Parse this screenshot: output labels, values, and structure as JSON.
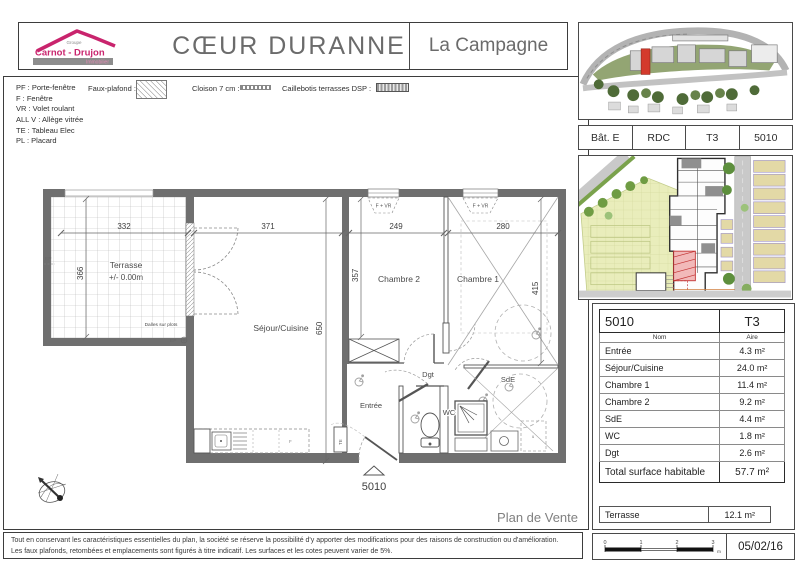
{
  "logo": {
    "group": "Groupe",
    "name": "Carnot - Drujon",
    "tagline": "Immobilier"
  },
  "header": {
    "title": "CŒUR DURANNE",
    "subtitle": "La Campagne"
  },
  "legend": {
    "abbreviations": [
      "PF : Porte-fenêtre",
      "F : Fenêtre",
      "VR : Volet roulant",
      "ALL V : Allège vitrée",
      "TE : Tableau Elec",
      "PL : Placard"
    ],
    "faux_plafond": "Faux-plafond :",
    "cloison": "Cloison 7 cm :",
    "caillebotis": "Caillebotis terrasses DSP :"
  },
  "sidebar": {
    "unit_row": [
      "Bât. E",
      "RDC",
      "T3",
      "5010"
    ],
    "area_table": {
      "unit": "5010",
      "type": "T3",
      "col_name": "Nom",
      "col_area": "Aire",
      "rows": [
        [
          "Entrée",
          "4.3 m²"
        ],
        [
          "Séjour/Cuisine",
          "24.0 m²"
        ],
        [
          "Chambre 1",
          "11.4 m²"
        ],
        [
          "Chambre 2",
          "9.2 m²"
        ],
        [
          "SdE",
          "4.4 m²"
        ],
        [
          "WC",
          "1.8 m²"
        ],
        [
          "Dgt",
          "2.6 m²"
        ]
      ],
      "total_label": "Total surface habitable",
      "total_value": "57.7 m²",
      "terrace_label": "Terrasse",
      "terrace_value": "12.1 m²"
    },
    "scale": {
      "t0": "0",
      "t1": "1",
      "t2": "2",
      "t3": "3",
      "unit": "m",
      "date": "05/02/16"
    }
  },
  "plan": {
    "rooms": {
      "terrasse": "Terrasse",
      "terrasse_level": "+/- 0.00m",
      "dalles": "Dalles sur plots",
      "sejour": "Séjour/Cuisine",
      "chambre2": "Chambre 2",
      "chambre1": "Chambre 1",
      "dgt": "Dgt",
      "entree": "Entrée",
      "wc": "WC",
      "sde": "SdE"
    },
    "dims": {
      "terrace_w": "332",
      "terrace_h": "366",
      "sejour_w": "371",
      "sejour_h": "650",
      "ch2_w": "249",
      "ch2_h": "357",
      "ch1_w": "280",
      "ch1_h": "415"
    },
    "annotations": {
      "ep": "EP",
      "te": "TE",
      "f_vr": "F + VR",
      "unit_number": "5010",
      "plan_label": "Plan de Vente"
    }
  },
  "footer": {
    "disclaimer_line1": "Tout en conservant les caractéristiques essentielles du plan, la société se réserve la possibilité d'y apporter des modifications pour des raisons de construction ou d'amélioration.",
    "disclaimer_line2": "Les faux plafonds, retombées et emplacements sont figurés à titre indicatif. Les surfaces et les cotes peuvent varier de 5%."
  },
  "colors": {
    "accent": "#c9246d",
    "wall": "#6f6f6f",
    "highlight_red": "#d43a2c",
    "text": "#4a4a4a"
  }
}
